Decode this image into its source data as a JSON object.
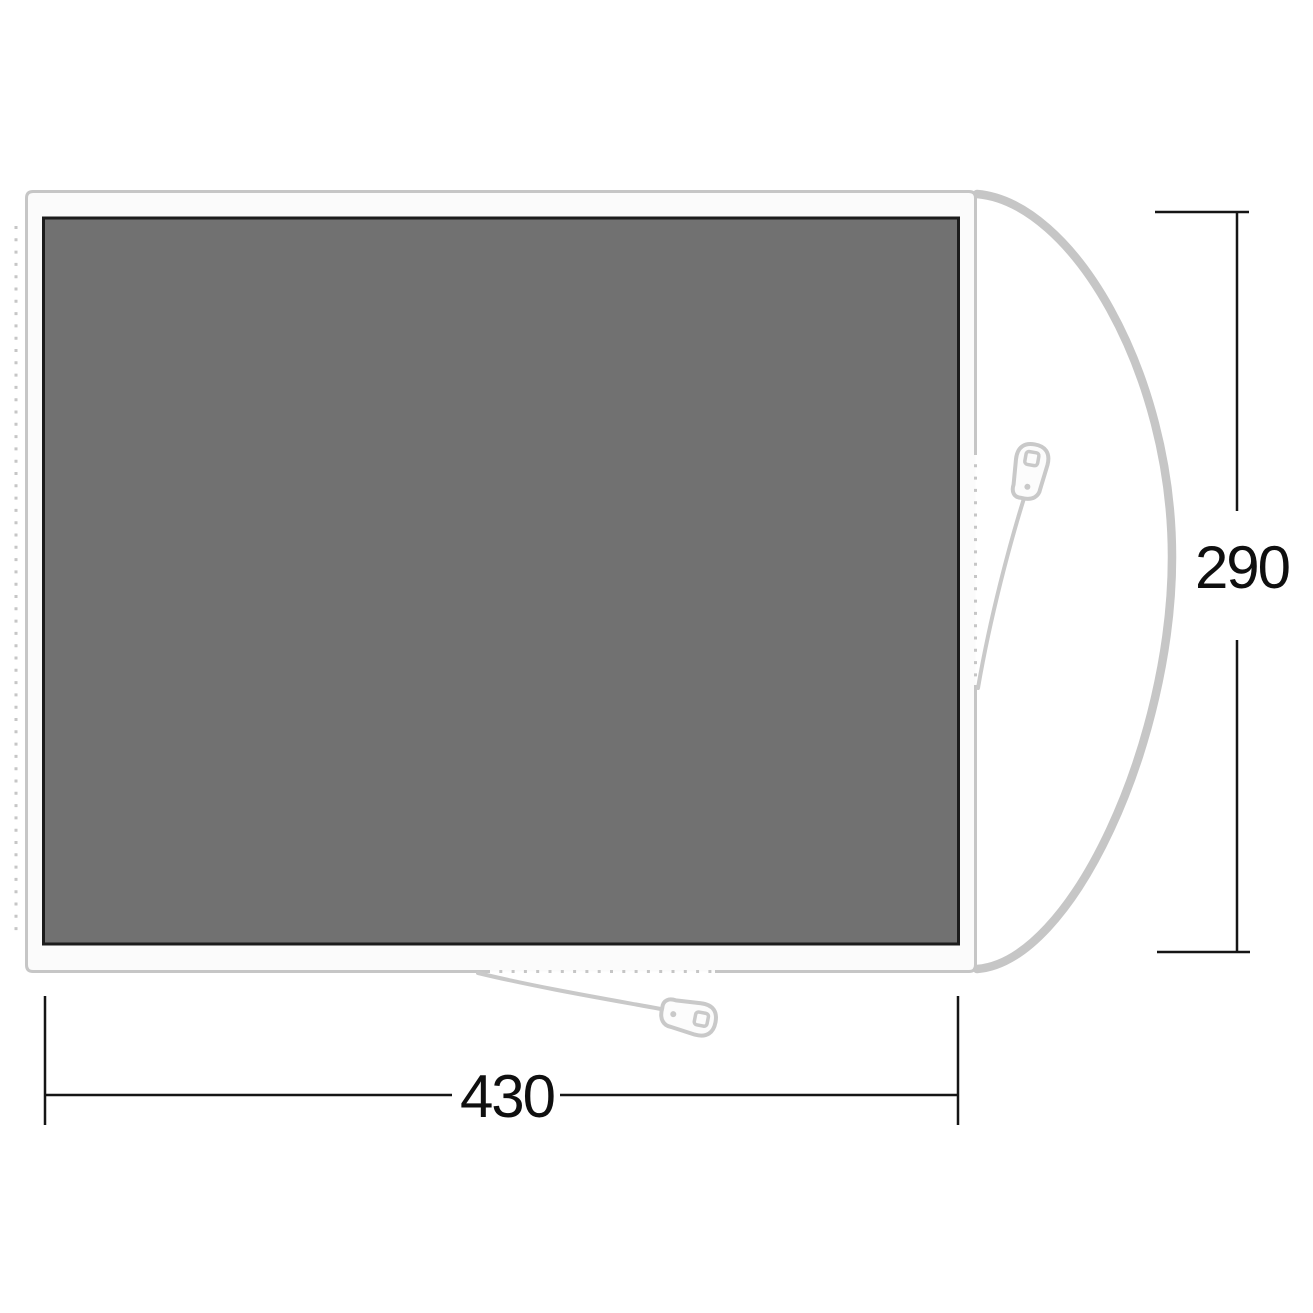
{
  "diagram": {
    "kind": "tent-footprint-floorplan",
    "dimensions": {
      "width_label": "430",
      "height_label": "290"
    },
    "colors": {
      "groundsheet_fill": "#717171",
      "groundsheet_border": "#1c1c1c",
      "frame_fill": "#fbfbfb",
      "frame_border": "#c6c6c6",
      "porch_outline": "#c6c6c6",
      "zipper_gray": "#c9c9c9",
      "dimension_line": "#151515"
    },
    "icons": {
      "zipper_pull": "zipper-pull-icon"
    }
  }
}
